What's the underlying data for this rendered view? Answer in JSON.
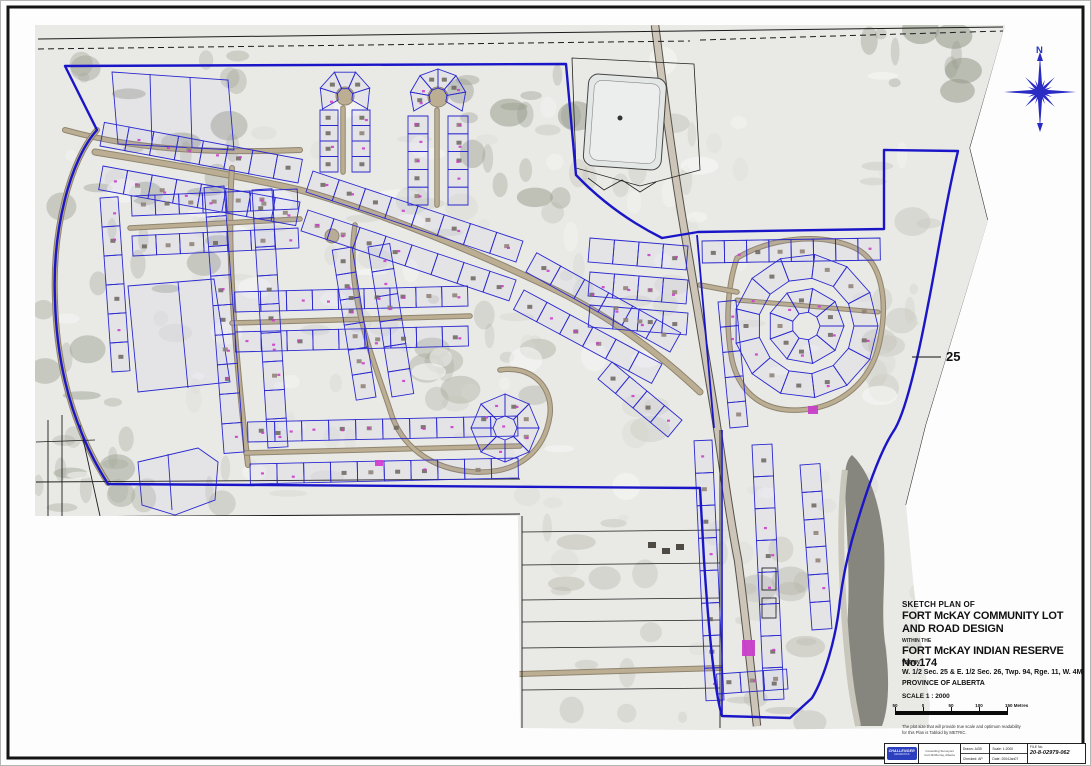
{
  "colors": {
    "paper": "#fdfdfd",
    "aerial_base": "#e9e9e6",
    "boundary_blue": "#1a16c8",
    "lot_blue": "#2a28cf",
    "pink_label": "#cc3ecb",
    "road_tan": "#bcae92",
    "road_casing": "#8f8570",
    "highway_gray": "#ccc5b8",
    "river_gray": "#87867e",
    "compass_blue": "#2a2ac4",
    "logo_blue": "#2b3fbf",
    "line_black": "#1c1c1c"
  },
  "compass": {
    "label": "N"
  },
  "section_label": {
    "text": "25"
  },
  "title_block": {
    "line1": "SKETCH PLAN OF",
    "line2": "FORT McKAY COMMUNITY LOT",
    "line3": "AND ROAD DESIGN",
    "line4": "WITHIN THE",
    "line5": "FORT McKAY INDIAN RESERVE No.174",
    "line6": "WITHIN",
    "line7": "W. 1/2 Sec. 25 & E. 1/2 Sec. 26, Twp. 94, Rge. 11, W. 4M.",
    "line8": "PROVINCE OF ALBERTA",
    "scale_text": "SCALE 1 : 2000",
    "scalebar_labels": [
      "50",
      "0",
      "50",
      "100",
      "150 Metres"
    ],
    "note_line1": "The plot size that will provide true scale and optimum readability",
    "note_line2": "for this Plan is Tabloid by METRIC."
  },
  "title_bar": {
    "logo_text": "CHALLENGER",
    "logo_sub": "GEOMATICS",
    "address_lines": [
      "Consulting Surveyors",
      "Fort McMurray, Alberta"
    ],
    "fields": [
      {
        "label": "Drawn:",
        "value": "AGB"
      },
      {
        "label": "Checked:",
        "value": "AP"
      },
      {
        "label": "Scale:",
        "value": "1:2000"
      },
      {
        "label": "Date:",
        "value": "2004Jan07"
      }
    ],
    "file_label": "FILE No.",
    "file_number": "20-8-02979-062"
  }
}
